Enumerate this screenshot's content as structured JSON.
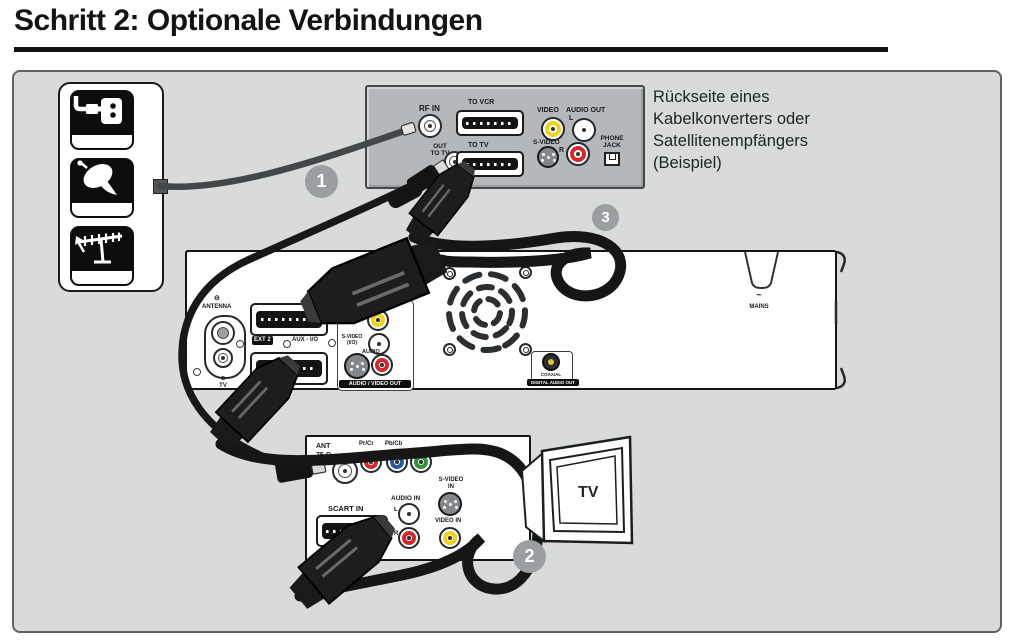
{
  "title": "Schritt 2: Optionale Verbindungen",
  "caption": [
    "Rückseite eines",
    "Kabelkonverters oder",
    "Satellitenempfängers",
    "(Beispiel)"
  ],
  "steps": {
    "s1": "1",
    "s2": "2",
    "s3": "3"
  },
  "source_icons": [
    "cable-wall-socket",
    "satellite-dish",
    "rooftop-antenna"
  ],
  "converter": {
    "rf_in": "RF IN",
    "to_vcr": "TO VCR",
    "video": "VIDEO",
    "audio_out": "AUDIO OUT",
    "audio_l": "L",
    "audio_r": "R",
    "s_video": "S-VIDEO",
    "phone_jack": "PHONE JACK",
    "out_to_tv": "OUT TO TV",
    "to_tv": "TO TV"
  },
  "recorder": {
    "antenna_symbol": "⊖",
    "antenna": "ANTENNA",
    "tv_symbol": "⊖",
    "tv": "TV",
    "ext2": "EXT 2",
    "aux": "AUX - I/O",
    "video_cvbs": "VIDEO (CVBS)",
    "s_video_io": "S-VIDEO (I/O)",
    "audio": "AUDIO",
    "av_out": "AUDIO / VIDEO OUT",
    "coaxial": "COAXIAL",
    "digital_audio_out": "DIGITAL AUDIO OUT",
    "mains_symbol": "~",
    "mains": "MAINS"
  },
  "tv_panel": {
    "ant": "ANT",
    "ohm": "75 Ω",
    "pr": "Pr/Cr",
    "pb": "Pb/Cb",
    "video_in_component": "VIDEO IN",
    "s_video_in": "S-VIDEO IN",
    "audio_in": "AUDIO IN",
    "l": "L",
    "r": "R",
    "video_in": "VIDEO IN",
    "scart_in": "SCART IN"
  },
  "tv": {
    "label": "TV"
  },
  "colors": {
    "diagram_bg": "#d9dbdb",
    "device_gray": "#b5b8ba",
    "cable_black": "#181818",
    "cable_gray": "#43474a",
    "badge_gray": "#9aa0a1",
    "jack_yellow": "#f2d117",
    "jack_red": "#d8262c",
    "jack_white": "#ffffff",
    "jack_blue": "#2757a8",
    "jack_green": "#2e8f3c"
  }
}
